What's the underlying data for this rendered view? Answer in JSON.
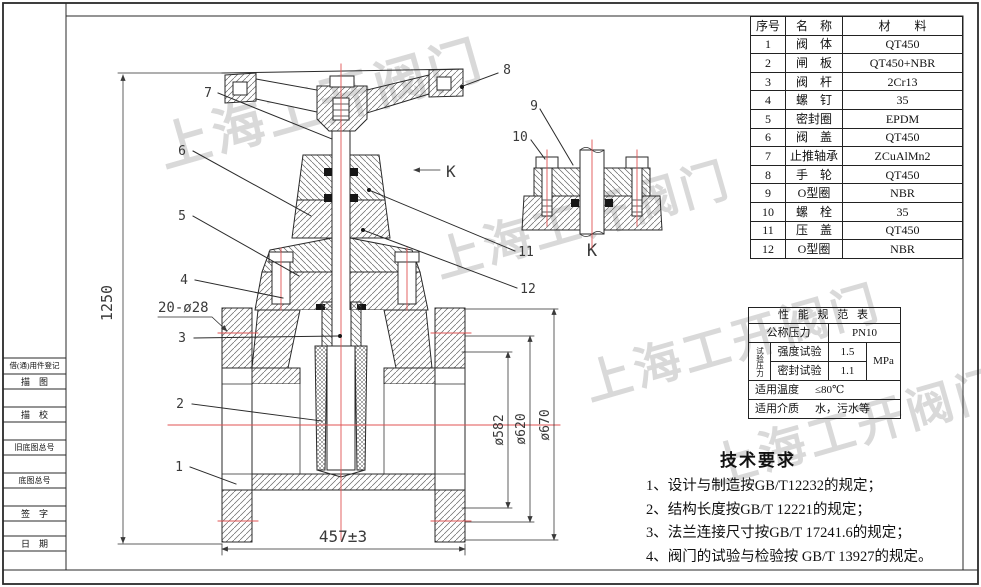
{
  "colors": {
    "centerline": "#e05353",
    "line": "#2a2a2a",
    "dim": "#3a3a3a",
    "watermark": "#c9c9c9"
  },
  "sheet": {
    "watermark": {
      "text": "上海工开阀门"
    },
    "title_strip": {
      "rows": [
        "借(通)用件登记",
        "描　图",
        "描　校",
        "旧底图总号",
        "底图总号",
        "签　字",
        "日　期"
      ]
    }
  },
  "parts_table": {
    "headers": [
      "序号",
      "名　称",
      "材　　料"
    ],
    "rows": [
      [
        "1",
        "阀　体",
        "QT450"
      ],
      [
        "2",
        "闸　板",
        "QT450+NBR"
      ],
      [
        "3",
        "阀　杆",
        "2Cr13"
      ],
      [
        "4",
        "螺　钉",
        "35"
      ],
      [
        "5",
        "密封圈",
        "EPDM"
      ],
      [
        "6",
        "阀　盖",
        "QT450"
      ],
      [
        "7",
        "止推轴承",
        "ZCuAlMn2"
      ],
      [
        "8",
        "手　轮",
        "QT450"
      ],
      [
        "9",
        "O型圈",
        "NBR"
      ],
      [
        "10",
        "螺　栓",
        "35"
      ],
      [
        "11",
        "压　盖",
        "QT450"
      ],
      [
        "12",
        "O型圈",
        "NBR"
      ]
    ]
  },
  "spec_table": {
    "title": "性 能 规 范 表",
    "nominal_pressure_label": "公称压力",
    "nominal_pressure_value": "PN10",
    "test_pressure_label": "试验压力",
    "strength_test_label": "强度试验",
    "strength_test_value": "1.5",
    "seal_test_label": "密封试验",
    "seal_test_value": "1.1",
    "unit": "MPa",
    "temp_label": "适用温度",
    "temp_value": "≤80℃",
    "medium_label": "适用介质",
    "medium_value": "水，污水等"
  },
  "tech_requirements": {
    "title": "技术要求",
    "items": [
      "1、设计与制造按GB/T12232的规定；",
      "2、结构长度按GB/T 12221的规定；",
      "3、法兰连接尺寸按GB/T 17241.6的规定；",
      "4、阀门的试验与检验按 GB/T 13927的规定。"
    ]
  },
  "drawing": {
    "dimensions": {
      "height": "1250",
      "face_to_face": "457±3",
      "bolt_holes": "20-ø28",
      "dia_inner": "ø582",
      "dia_bolt_circle": "ø620",
      "dia_outer": "ø670"
    },
    "view_label_direction": "K",
    "view_label_section": "K",
    "balloons": {
      "n1": "1",
      "n2": "2",
      "n3": "3",
      "n4": "4",
      "n5": "5",
      "n6": "6",
      "n7": "7",
      "n8": "8",
      "n9": "9",
      "n10": "10",
      "n11": "11",
      "n12": "12"
    }
  }
}
